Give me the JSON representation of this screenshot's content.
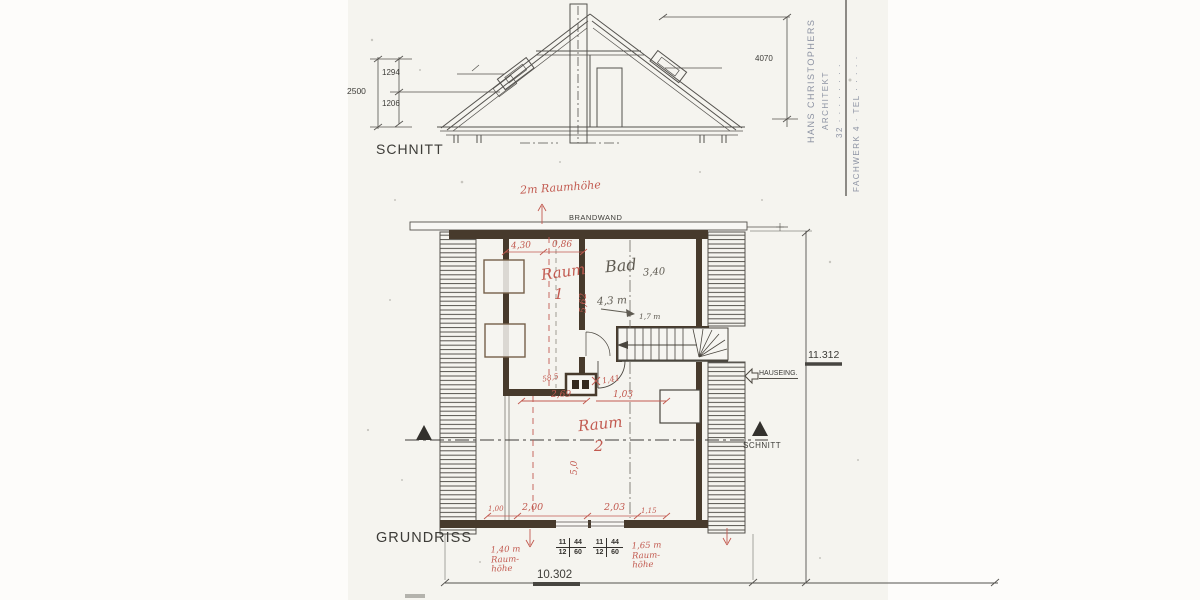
{
  "section": {
    "title": "SCHNITT",
    "dim_total": "2500",
    "dim_upper": "1294",
    "dim_lower": "1206",
    "dim_right": "4070"
  },
  "stamp": {
    "line1": "HANS CHRISTOPHERS",
    "line2": "ARCHITEKT",
    "line3": "32 · · · · · · · ·",
    "line4": "FACHWERK 4 · TEL · · · · ·"
  },
  "plan": {
    "title": "GRUNDRISS",
    "firewall": "BRANDWAND",
    "room1_word": "Raum",
    "room1_num": "1",
    "room2_word": "Raum",
    "room2_num": "2",
    "bathroom": "Bad",
    "bathroom_dim": "3,40",
    "entrance_label": "HAUSEING.",
    "section_marker": "SCHNITT",
    "dim_width": "10.302",
    "dim_height": "11.312",
    "window_fraction": {
      "a": "11",
      "b": "44",
      "c": "12",
      "d": "60"
    }
  },
  "annotations_red": {
    "top_note": "2m Raumhöhe",
    "dim_430": "4,30",
    "dim_086": "0,86",
    "dim_562": "5,62",
    "dim_585": "58,5",
    "dim_269": "2,69",
    "dim_103": "1,03",
    "dim_141": "1,41",
    "dim_100": "1,00",
    "dim_200": "2,00",
    "dim_203": "2,03",
    "dim_115": "1,15",
    "dim_50": "5,0",
    "left_note": "1,40 m\nRaum-\nhöhe",
    "right_note": "1,65 m\nRaum-\nhöhe"
  },
  "annotations_pencil": {
    "dim_43m": "4,3 m",
    "dim_17m": "1,7 m"
  },
  "colors": {
    "red_ink": "#c25a50",
    "pencil": "#5f5b52",
    "line": "#54524e",
    "wall_fill": "#473a2c",
    "stamp_blue": "#8d93a3",
    "paper": "#f5f4ef"
  }
}
